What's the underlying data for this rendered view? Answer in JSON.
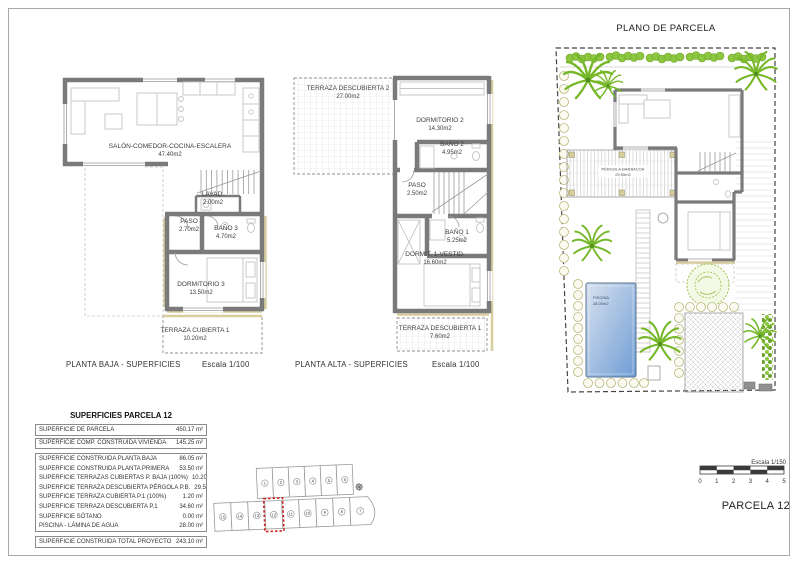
{
  "sheet": {
    "parcel_label": "PARCELA 12"
  },
  "planta_baja": {
    "caption": "PLANTA BAJA - SUPERFICIES",
    "scale": "Escala 1/100",
    "rooms": [
      {
        "name": "SALÓN-COMEDOR-COCINA-ESCALERA",
        "area": "47.40m2"
      },
      {
        "name": "LAVAD.",
        "area": "2.00m2"
      },
      {
        "name": "PASO",
        "area": "2.70m2"
      },
      {
        "name": "BAÑO 3",
        "area": "4.70m2"
      },
      {
        "name": "DORMITORIO 3",
        "area": "13.50m2"
      },
      {
        "name": "TERRAZA CUBIERTA 1",
        "area": "10.20m2"
      }
    ]
  },
  "planta_alta": {
    "caption": "PLANTA ALTA - SUPERFICIES",
    "scale": "Escala 1/100",
    "rooms": [
      {
        "name": "TERRAZA DESCUBIERTA 2",
        "area": "27.00m2"
      },
      {
        "name": "DORMITORIO 2",
        "area": "14.30m2"
      },
      {
        "name": "BAÑO 2",
        "area": "4.95m2"
      },
      {
        "name": "PASO",
        "area": "2.50m2"
      },
      {
        "name": "BAÑO 1",
        "area": "5.25m2"
      },
      {
        "name": "DORMIT. 1-VESTID.",
        "area": "16.60m2"
      },
      {
        "name": "TERRAZA DESCUBIERTA 1",
        "area": "7.60m2"
      }
    ]
  },
  "site_plan": {
    "title": "PLANO DE PARCELA",
    "pergola": {
      "name": "PÉRGOLA-BARBACOA",
      "area": "29.55m2"
    },
    "pool": {
      "name": "PISCINA",
      "area": "28.00m2"
    }
  },
  "summary_table": {
    "title": "SUPERFICIES PARCELA 12",
    "rows": [
      {
        "label": "SUPERFICIE DE PARCELA",
        "value": "450.17 m²"
      },
      {
        "label": "SUPERFICIE COMP. CONSTRUIDA VIVIENDA",
        "value": "145.25 m²"
      },
      {
        "label": "SUPERFICIE CONSTRUIDA PLANTA BAJA",
        "value": "86.05 m²"
      },
      {
        "label": "SUPERFICIE CONSTRUIDA PLANTA PRIMERA",
        "value": "53.50 m²"
      },
      {
        "label": "SUPERFICIE TERRAZAS CUBIERTAS P. BAJA (100%)",
        "value": "10.20 m²"
      },
      {
        "label": "SUPERFICIE TERRAZA DESCUBIERTA PÉRGOLA P.B.",
        "value": "29.55 m²"
      },
      {
        "label": "SUPERFICIE TERRAZA CUBIERTA P.1 (100%)",
        "value": "1.20 m²"
      },
      {
        "label": "SUPERFICIE TERRAZA DESCUBIERTA P.1",
        "value": "34.60 m²"
      },
      {
        "label": "SUPERFICIE SÓTANO",
        "value": "0.00 m²"
      },
      {
        "label": "PISCINA - LÁMINA DE AGUA",
        "value": "28.00 m²"
      },
      {
        "label": "SUPERFICIE CONSTRUIDA TOTAL PROYECTO",
        "value": "243.10 m²"
      }
    ]
  },
  "key_plan": {
    "top_row": [
      "1",
      "2",
      "3",
      "4",
      "5",
      "6"
    ],
    "bottom_row": [
      "15",
      "14",
      "13",
      "12",
      "11",
      "10",
      "9",
      "8",
      "7"
    ],
    "highlighted": "12"
  },
  "scale_bar": {
    "label": "Escala 1/150",
    "ticks": [
      "0",
      "1",
      "2",
      "3",
      "4",
      "5"
    ]
  },
  "colors": {
    "wall": "#7a7a7a",
    "accent_beige": "#d8cd9d",
    "palm_green": "#76b82a",
    "hedge_green": "#8dc63f",
    "pool_start": "#d8e2ef",
    "pool_end": "#6f9cd4",
    "highlight_red": "#cc2222"
  }
}
